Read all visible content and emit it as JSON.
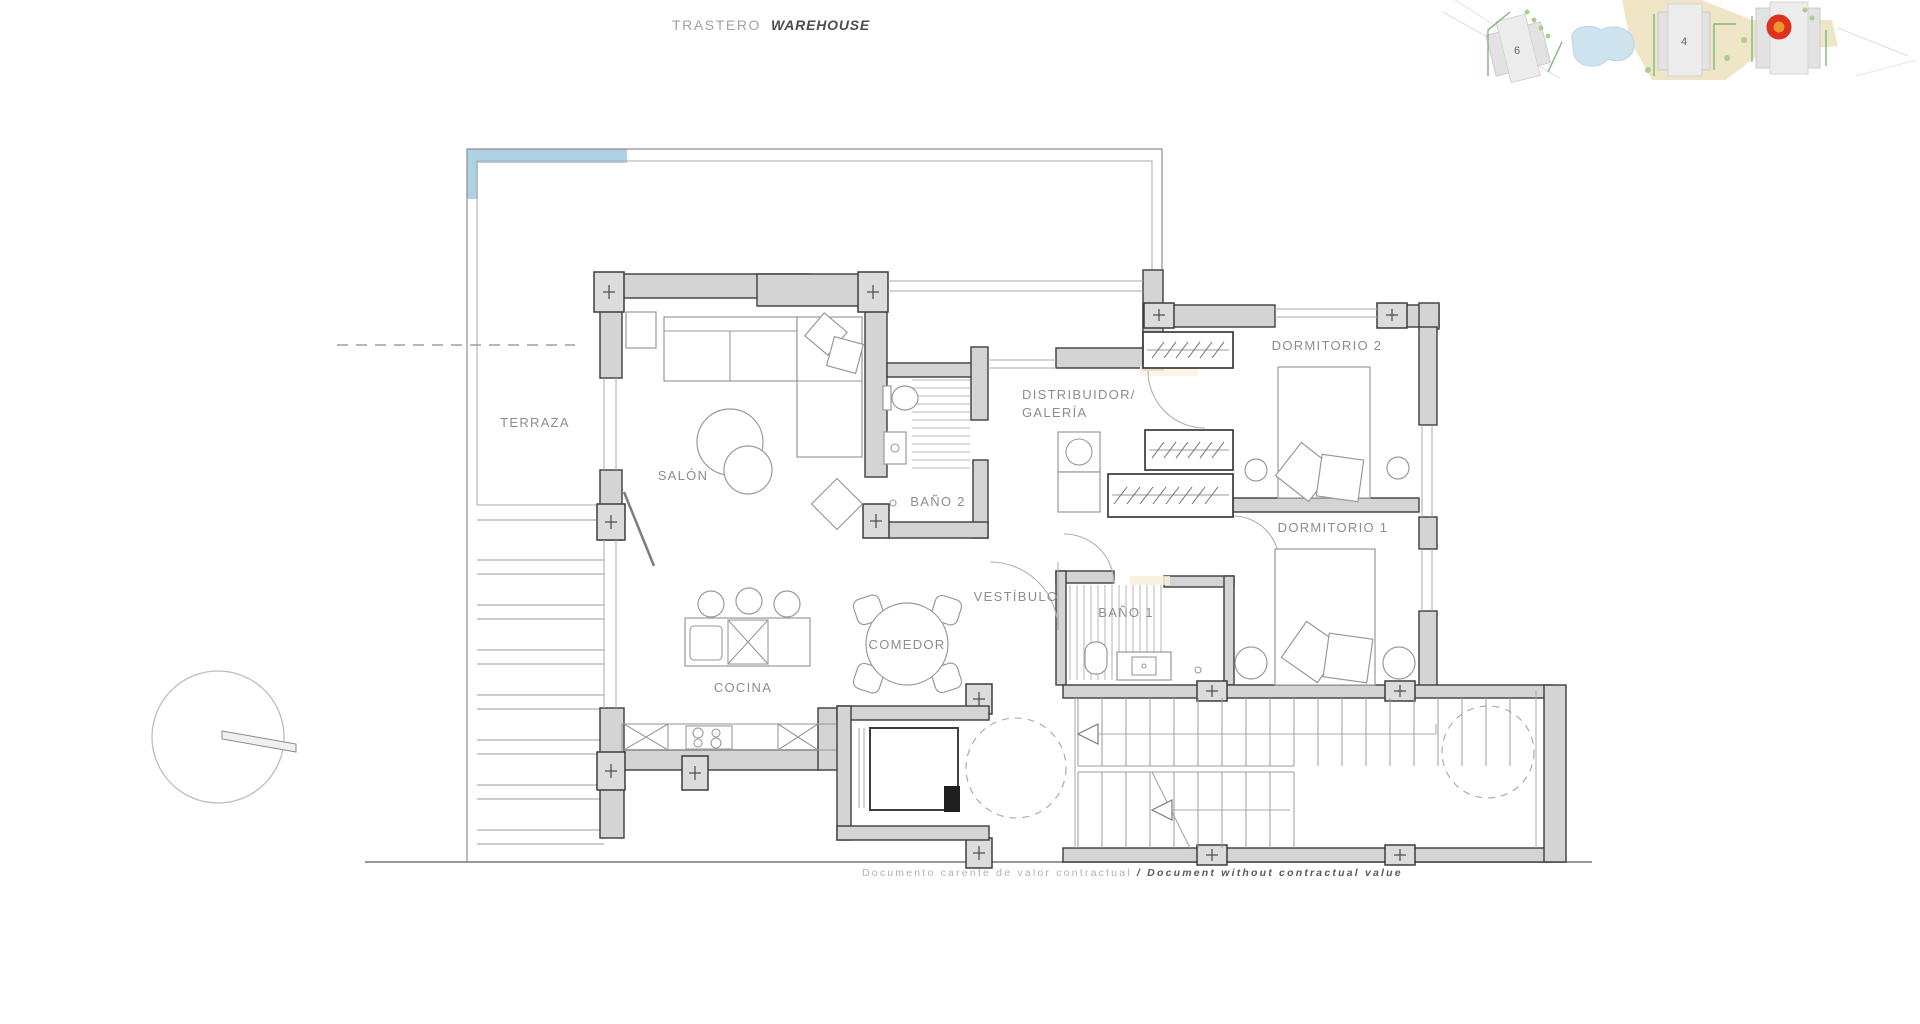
{
  "title": {
    "es": "TRASTERO",
    "en": "WAREHOUSE"
  },
  "rooms": {
    "terraza": "TERRAZA",
    "salon": "SALÓN",
    "bano2": "BAÑO 2",
    "distribuidor_line1": "DISTRIBUIDOR/",
    "distribuidor_line2": "GALERÍA",
    "dormitorio2": "DORMITORIO 2",
    "dormitorio1": "DORMITORIO 1",
    "vestibulo": "VESTÍBULO",
    "bano1": "BAÑO 1",
    "comedor": "COMEDOR",
    "cocina": "COCINA"
  },
  "site_map": {
    "building_labels": [
      "6",
      "4"
    ],
    "marker_color": "#e0301e",
    "road_color": "#ece0bd",
    "pool_color": "#cfe3ee",
    "green_color": "#7cb87c"
  },
  "plan_colors": {
    "wall_fill": "#d4d4d4",
    "terrace_highlight": "#aed2e2"
  },
  "disclaimer": {
    "es": "Documento carente de valor contractual",
    "sep": "/",
    "en": "Document without contractual value"
  }
}
